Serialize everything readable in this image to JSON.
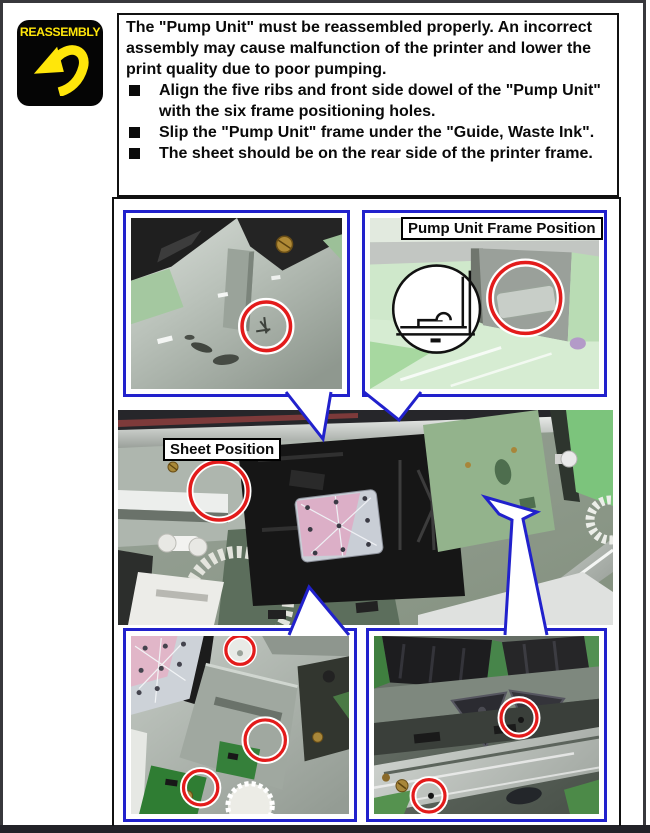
{
  "badge": {
    "label": "REASSEMBLY"
  },
  "instruction": {
    "paragraph": "The \"Pump Unit\" must be reassembled properly. An incorrect assembly may cause malfunction of the printer and lower the print quality due to poor pumping.",
    "bullets": [
      "Align the five ribs and front side dowel of the \"Pump Unit\" with the six frame positioning holes.",
      "Slip the \"Pump Unit\" frame under the \"Guide, Waste Ink\".",
      "The sheet should be on the rear side of the printer frame."
    ]
  },
  "figure": {
    "labels": {
      "pump_frame": "Pump Unit Frame Position",
      "sheet": "Sheet Position"
    }
  },
  "colors": {
    "badge_bg": "#050505",
    "badge_accent": "#ffe60a",
    "callout_border": "#2121cc",
    "highlight_ring": "#e31b1b",
    "page_border": "#38383c"
  }
}
